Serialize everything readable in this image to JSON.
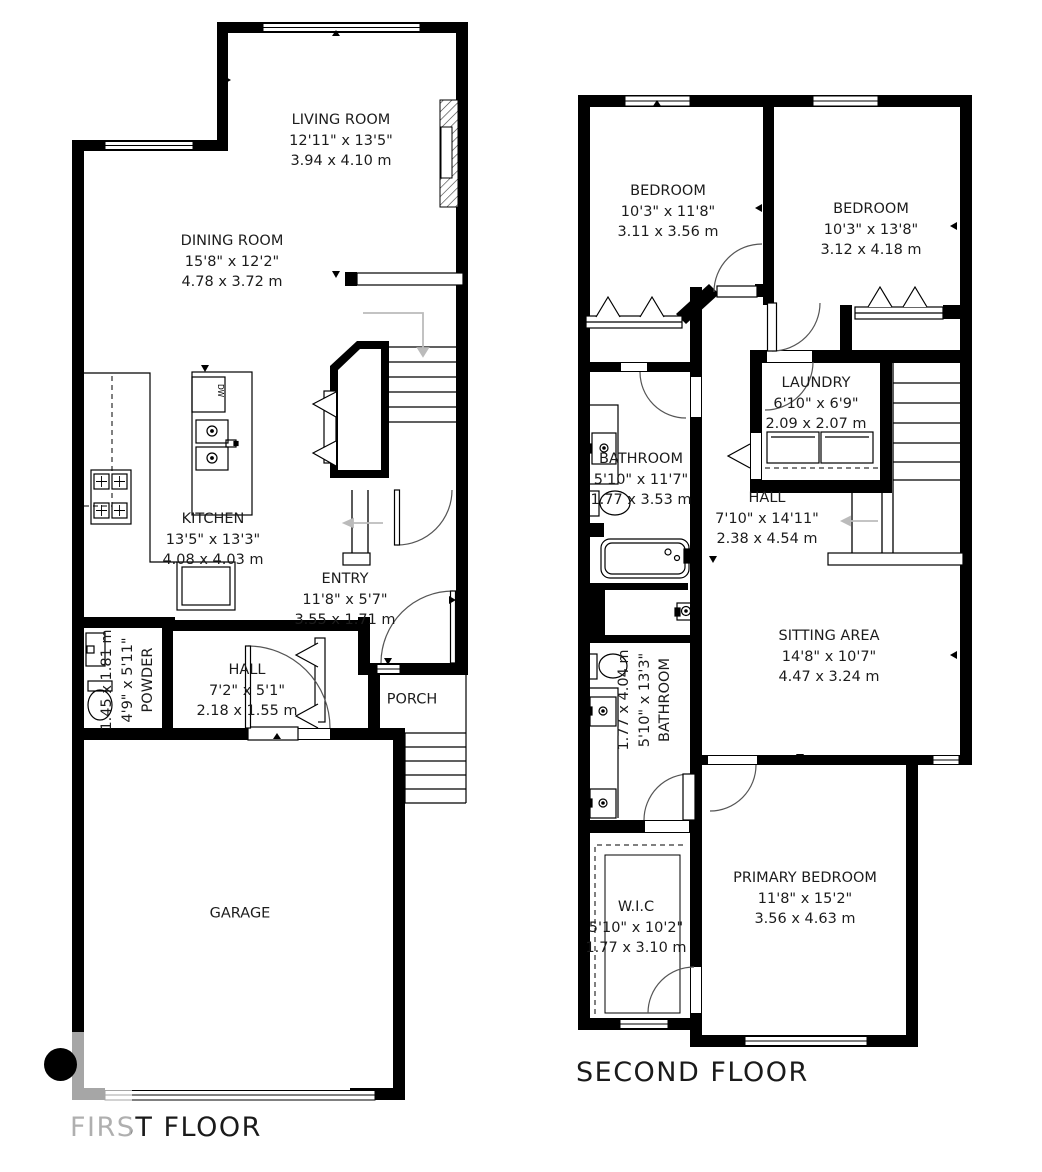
{
  "first_floor": {
    "title": "FIRST FLOOR",
    "rooms": {
      "living": {
        "name": "LIVING ROOM",
        "imperial": "12'11\" x 13'5\"",
        "metric": "3.94 x 4.10 m"
      },
      "dining": {
        "name": "DINING ROOM",
        "imperial": "15'8\" x 12'2\"",
        "metric": "4.78 x 3.72 m"
      },
      "kitchen": {
        "name": "KITCHEN",
        "imperial": "13'5\" x 13'3\"",
        "metric": "4.08 x 4.03 m"
      },
      "entry": {
        "name": "ENTRY",
        "imperial": "11'8\" x 5'7\"",
        "metric": "3.55 x 1.71 m"
      },
      "powder": {
        "name": "POWDER",
        "imperial": "4'9\" x 5'11\"",
        "metric": "1.45 x 1.81 m"
      },
      "hall": {
        "name": "HALL",
        "imperial": "7'2\" x 5'1\"",
        "metric": "2.18 x 1.55 m"
      },
      "porch": {
        "name": "PORCH"
      },
      "garage": {
        "name": "GARAGE"
      }
    },
    "fixtures": {
      "dishwasher": "DW"
    }
  },
  "second_floor": {
    "title": "SECOND FLOOR",
    "rooms": {
      "bedroom_left": {
        "name": "BEDROOM",
        "imperial": "10'3\" x 11'8\"",
        "metric": "3.11 x 3.56 m"
      },
      "bedroom_right": {
        "name": "BEDROOM",
        "imperial": "10'3\" x 13'8\"",
        "metric": "3.12 x 4.18 m"
      },
      "laundry": {
        "name": "LAUNDRY",
        "imperial": "6'10\" x 6'9\"",
        "metric": "2.09 x 2.07 m"
      },
      "bathroom_top": {
        "name": "BATHROOM",
        "imperial": "5'10\" x 11'7\"",
        "metric": "1.77 x 3.53 m"
      },
      "hall": {
        "name": "HALL",
        "imperial": "7'10\" x 14'11\"",
        "metric": "2.38 x 4.54 m"
      },
      "sitting": {
        "name": "SITTING AREA",
        "imperial": "14'8\" x 10'7\"",
        "metric": "4.47 x 3.24 m"
      },
      "bathroom_bottom": {
        "name": "BATHROOM",
        "imperial": "5'10\" x 13'3\"",
        "metric": "1.77 x 4.04 m"
      },
      "wic": {
        "name": "W.I.C",
        "imperial": "5'10\" x 10'2\"",
        "metric": "1.77 x 3.10 m"
      },
      "primary": {
        "name": "PRIMARY BEDROOM",
        "imperial": "11'8\" x 15'2\"",
        "metric": "3.56 x 4.63 m"
      }
    }
  }
}
